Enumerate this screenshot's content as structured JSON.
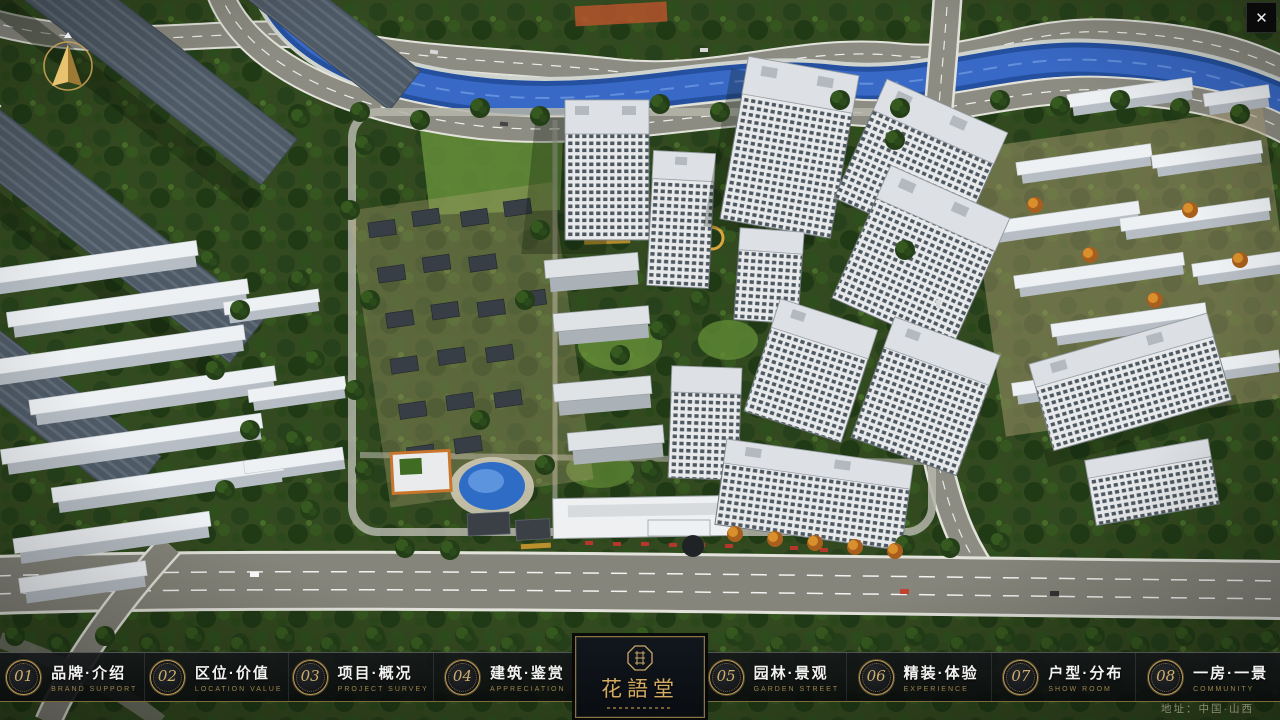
{
  "close": {
    "label": "✕"
  },
  "nav": {
    "items": [
      {
        "num": "01",
        "zh": "品牌·介绍",
        "en": "BRAND SUPPORT"
      },
      {
        "num": "02",
        "zh": "区位·价值",
        "en": "LOCATION VALUE"
      },
      {
        "num": "03",
        "zh": "项目·概况",
        "en": "PROJECT SURVEY"
      },
      {
        "num": "04",
        "zh": "建筑·鉴赏",
        "en": "APPRECIATION"
      },
      {
        "num": "05",
        "zh": "园林·景观",
        "en": "GARDEN STREET"
      },
      {
        "num": "06",
        "zh": "精装·体验",
        "en": "EXPERIENCE"
      },
      {
        "num": "07",
        "zh": "户型·分布",
        "en": "SHOW ROOM"
      },
      {
        "num": "08",
        "zh": "一房·一景",
        "en": "COMMUNITY"
      }
    ]
  },
  "logo": {
    "title": "花語堂"
  },
  "footer": {
    "address": "地址：中国·山西"
  },
  "colors": {
    "gold": "#bb9d5c",
    "navbar_bg": "#0c0e11",
    "river": "#2f6cc5"
  }
}
